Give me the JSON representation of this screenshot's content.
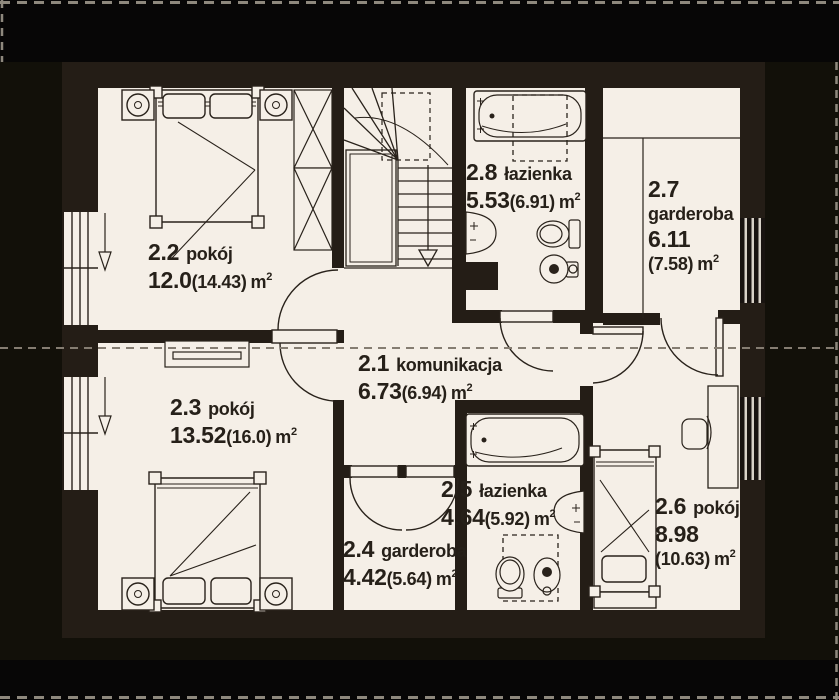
{
  "meta": {
    "drawing_type": "floor plan (attic storey)",
    "language": "Polish"
  },
  "palette": {
    "background": "#121009",
    "outer_band": "#070606",
    "wall": "#241d16",
    "floor": "#f5efe7",
    "line": "#29221b",
    "dashed_line": "#857d72",
    "border_dash": "#8e887d",
    "text": "#262019"
  },
  "units": {
    "m": "m",
    "sup": "2"
  },
  "rooms": {
    "r21": {
      "num": "2.1",
      "name": "komunikacja",
      "area": "6.73",
      "area_alt": "(6.94)"
    },
    "r22": {
      "num": "2.2",
      "name": "pokój",
      "area": "12.0",
      "area_alt": "(14.43)"
    },
    "r23": {
      "num": "2.3",
      "name": "pokój",
      "area": "13.52",
      "area_alt": "(16.0)"
    },
    "r24": {
      "num": "2.4",
      "name": "garderoba",
      "area": "4.42",
      "area_alt": "(5.64)"
    },
    "r25": {
      "num": "2.5",
      "name": "łazienka",
      "area": "4.64",
      "area_alt": "(5.92)"
    },
    "r26": {
      "num": "2.6",
      "name": "pokój",
      "area": "8.98",
      "area_alt": "(10.63)"
    },
    "r27": {
      "num": "2.7",
      "name": "garderoba",
      "area": "6.11",
      "area_alt": "(7.58)"
    },
    "r28": {
      "num": "2.8",
      "name": "łazienka",
      "area": "5.53",
      "area_alt": "(6.91)"
    }
  }
}
